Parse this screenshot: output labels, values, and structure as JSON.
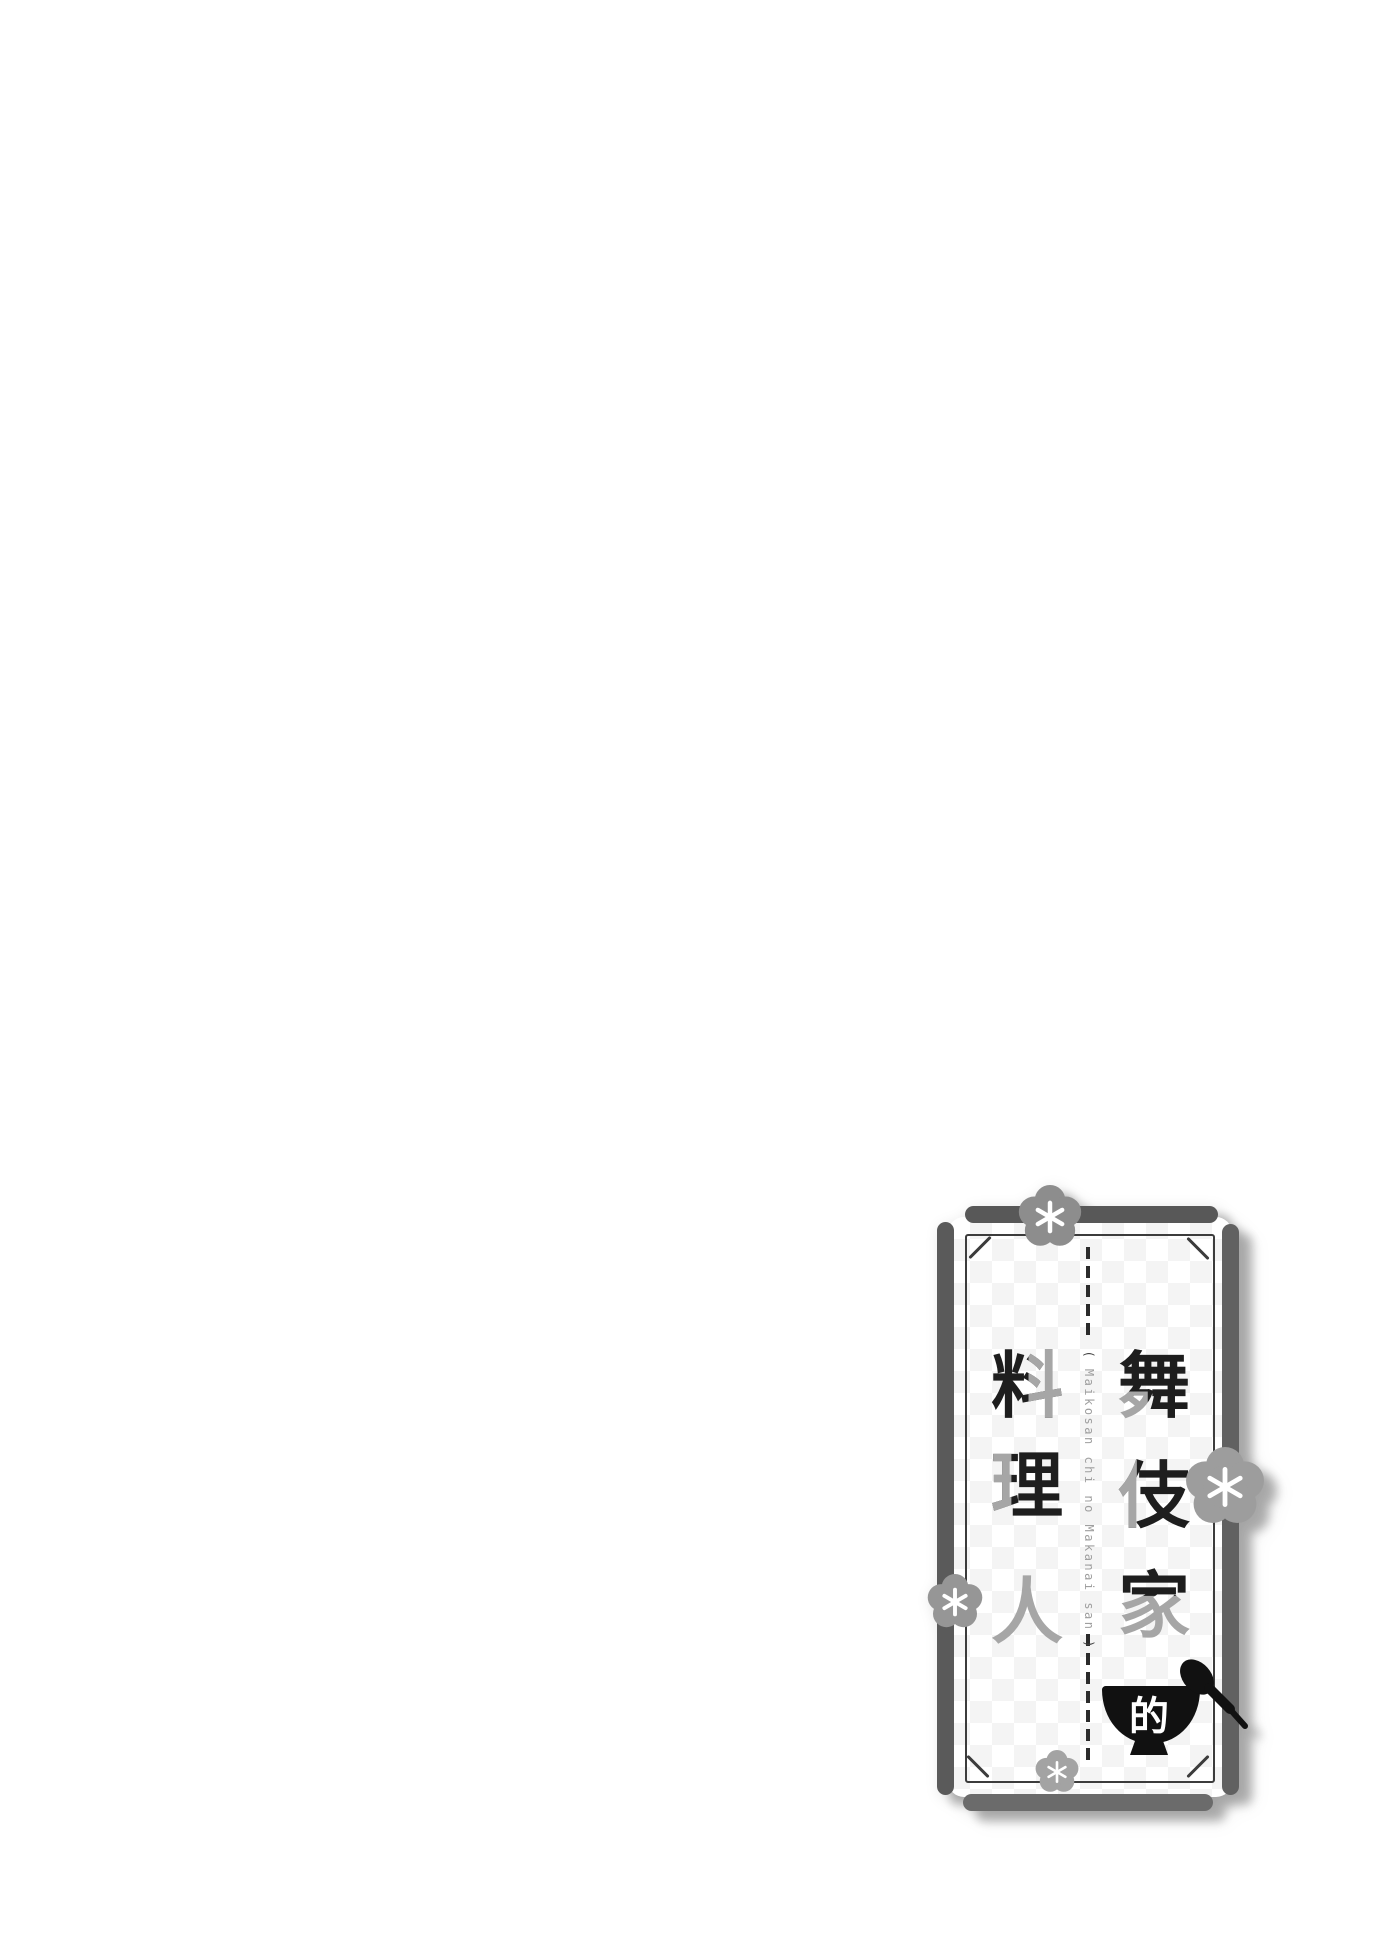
{
  "page": {
    "kind": "manga title page",
    "background_color": "#ffffff"
  },
  "title_card": {
    "title_full": "舞伎家的料理人",
    "columns": {
      "right": [
        {
          "char": "舞"
        },
        {
          "char": "伎"
        },
        {
          "char": "家"
        }
      ],
      "left": [
        {
          "char": "料"
        },
        {
          "char": "理"
        },
        {
          "char": "人"
        }
      ],
      "particle": {
        "char": "的"
      }
    },
    "romanization": {
      "open_paren": "(",
      "text": "Maikosan chi no Makanai san",
      "close_paren": ")"
    },
    "colors": {
      "ink_black": "#1e1e1e",
      "ink_gray": "#a6a6a6",
      "border_bar_gray": "#5a5a5a",
      "bottom_bar_gray": "#6b6b6b",
      "frame_line": "#3c3c3c",
      "checker_gray": "#f4f4f4",
      "flower_gray": "#949494",
      "bowl_black": "#111111",
      "romanization_gray": "#9f9f9f"
    },
    "decorations": [
      "plum-blossom-top",
      "plum-blossom-right",
      "plum-blossom-left",
      "plum-blossom-bottom",
      "rice-bowl",
      "spoon"
    ]
  }
}
